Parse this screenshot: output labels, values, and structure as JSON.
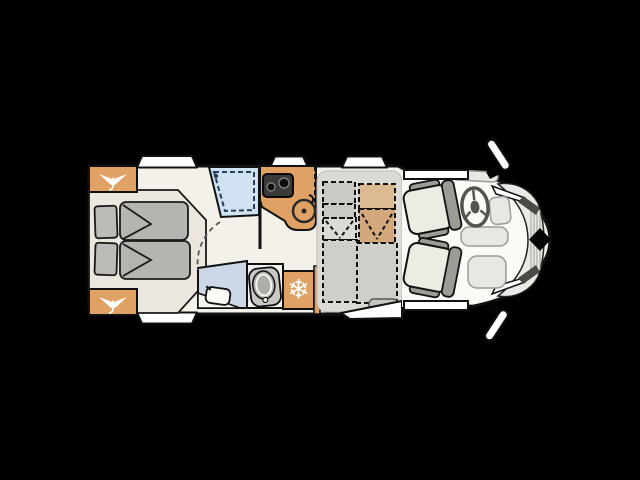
{
  "scene": {
    "type": "motorhome-floorplan-top-view",
    "vehicle_facing": "right",
    "background_color": "#000000"
  },
  "palette": {
    "body_fill": "#f4f1ea",
    "outline": "#111111",
    "cabinet_wood": "#e0a264",
    "table_wood": "#d9b68d",
    "bed_platform": "#ebe7df",
    "mattress_gray": "#b5b4b1",
    "shower_blue": "#d0e1f2",
    "shower_dash_blue": "#27405e",
    "bathroom_blue": "#ccd8e7",
    "dinette_floor": "#dbdad5",
    "dashed_seat_gray": "#cac9c4",
    "cab_floor": "#fafaf6",
    "seat_bolster_gray": "#9c9b96",
    "window_white": "#ffffff",
    "stove_black": "#3a3a38"
  },
  "icons": {
    "snowflake_glyph": "❄",
    "wardrobe_hanger": "clothes-hanger",
    "fridge": "snowflake",
    "badge": "black-diamond"
  },
  "rooms": {
    "rear_bedroom": {
      "name": "rear-twin-beds",
      "beds": 2,
      "pillows": 2,
      "duvets": 2,
      "wardrobes": 2
    },
    "washroom": {
      "name": "shower-and-bathroom",
      "shower": 1,
      "toilet": 1,
      "washbasin": 1
    },
    "kitchen": {
      "name": "kitchenette",
      "hob_burners": 2,
      "sink": 1,
      "fridge": 1
    },
    "dinette": {
      "name": "half-dinette",
      "table": 1,
      "belted_seats": 2,
      "bench_elements": 4,
      "entry_step": 1
    },
    "cab": {
      "name": "driver-cab",
      "swivel_seats": 2,
      "steering_wheel": 1,
      "mirrors": 2,
      "badge": 1
    }
  },
  "openings": {
    "windows_top": 3,
    "windows_bottom": 1,
    "cab_door_windows": 2,
    "entry_door_step": 1
  }
}
